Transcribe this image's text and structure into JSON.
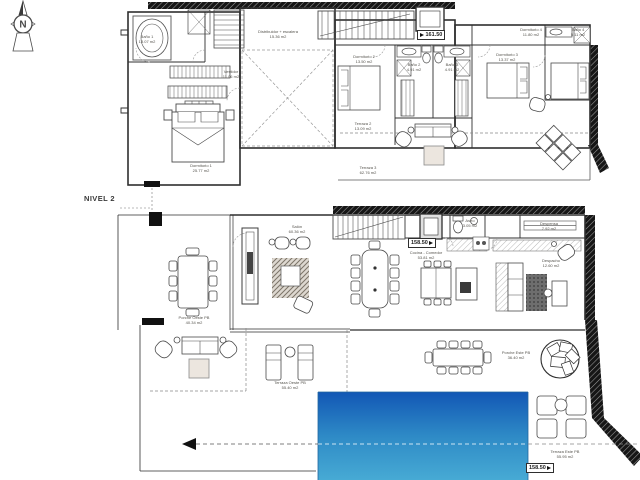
{
  "compass": {
    "letter": "N"
  },
  "level_label": "NIVEL 2",
  "markers": [
    {
      "value": "161.50"
    },
    {
      "value": "158.50"
    },
    {
      "value": "158.50"
    }
  ],
  "top_plan": {
    "labels": [
      {
        "text": "Baño 1\n13.07 m2"
      },
      {
        "text": "Distribuidor + escalera\n15.36 m2"
      },
      {
        "text": "Vestidor\n11.06 m2"
      },
      {
        "text": "Dormitorio 1\n25.77 m2"
      },
      {
        "text": "Dormitorio 2\n13.50 m2"
      },
      {
        "text": "Baño 2\n4.91 m2"
      },
      {
        "text": "Baño 3\n4.91 m2"
      },
      {
        "text": "Dormitorio 3\n13.37 m2"
      },
      {
        "text": "Dormitorio 4\n11.80 m2"
      },
      {
        "text": "Baño 4\n5.11 m2"
      },
      {
        "text": "Terraza 2\n13.09 m2"
      },
      {
        "text": "Terraza 3\n62.76 m2"
      }
    ]
  },
  "bottom_plan": {
    "labels": [
      {
        "text": "Salón\n60.36 m2"
      },
      {
        "text": "Porche Oeste PB\n40.34 m2"
      },
      {
        "text": "Cocina - Comedor\n53.81 m2"
      },
      {
        "text": "Aseo\n3.05 m2"
      },
      {
        "text": "Despensa\n7.92 m2"
      },
      {
        "text": "Despacho\n12.60 m2"
      },
      {
        "text": "Terraza Oeste PB\n55.40 m2"
      },
      {
        "text": "Porche Este PB\n36.40 m2"
      },
      {
        "text": "Terraza Este PB\n55.95 m2"
      }
    ]
  },
  "colors": {
    "line": "#2f2f2f",
    "pool_top": "#1257b5",
    "pool_mid": "#2e8ac6",
    "pool_bottom": "#47aad4",
    "wall_hatch": "#161616"
  }
}
